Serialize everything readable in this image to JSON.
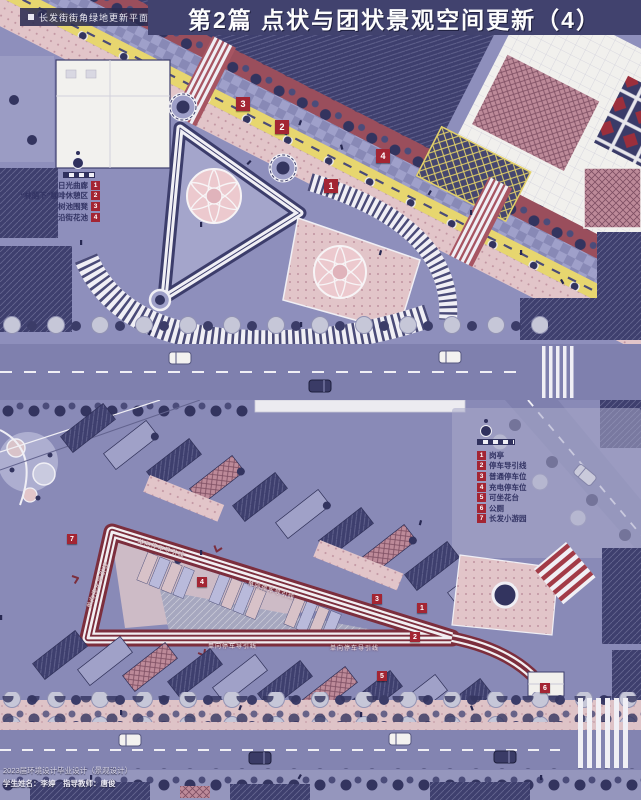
{
  "header": {
    "title": "第2篇 点状与团状景观空间更新（4）"
  },
  "top_plan": {
    "label": "长发街街角绿地更新平面图",
    "legend": {
      "items": [
        {
          "num": "1",
          "label": "日光曲廊"
        },
        {
          "num": "2",
          "label": "“林荫下”咖啡休憩区"
        },
        {
          "num": "3",
          "label": "树池围凳"
        },
        {
          "num": "4",
          "label": "沿街花池"
        }
      ]
    },
    "markers": [
      {
        "num": "1"
      },
      {
        "num": "2"
      },
      {
        "num": "3"
      },
      {
        "num": "4"
      }
    ]
  },
  "bottom_plan": {
    "legend": {
      "items": [
        {
          "num": "1",
          "label": "岗亭"
        },
        {
          "num": "2",
          "label": "停车导引线"
        },
        {
          "num": "3",
          "label": "普通停车位"
        },
        {
          "num": "4",
          "label": "充电停车位"
        },
        {
          "num": "5",
          "label": "可坐花台"
        },
        {
          "num": "6",
          "label": "公厕"
        },
        {
          "num": "7",
          "label": "长发小游园"
        }
      ]
    },
    "flow_label": "单向停车导引线",
    "markers": [
      {
        "num": "1"
      },
      {
        "num": "2"
      },
      {
        "num": "3"
      },
      {
        "num": "4"
      },
      {
        "num": "5"
      },
      {
        "num": "6"
      },
      {
        "num": "7"
      }
    ]
  },
  "footer": {
    "line1": "2023届环境设计毕业设计（景观设计）",
    "line2": "学生姓名：李婷　指导教师：唐俊"
  },
  "colors": {
    "header_bg": "#41426e",
    "marker_red": "#a32533",
    "loop_red": "#7c2e3d",
    "bike_lane_yellow": "#e7d66f",
    "ground_lavender": "#8e8fbc"
  }
}
